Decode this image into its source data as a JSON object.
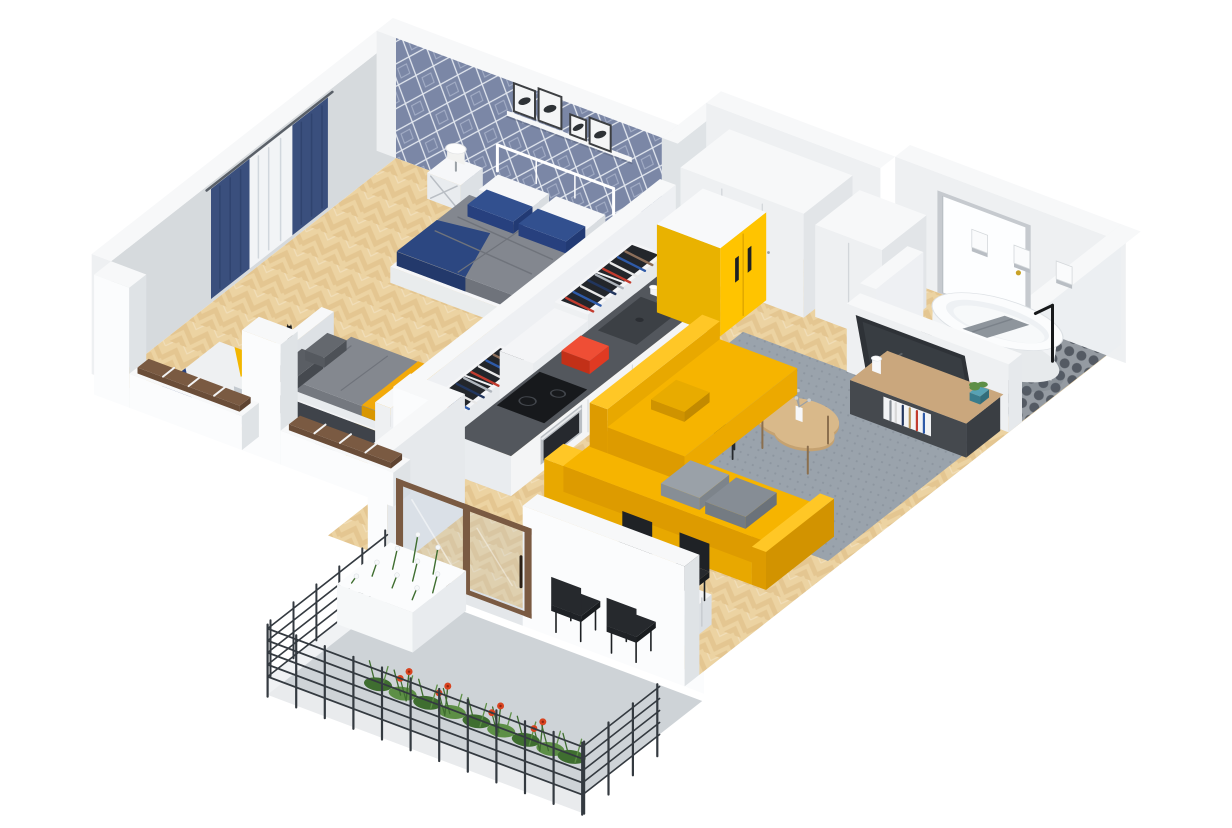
{
  "meta": {
    "description": "3D isometric cutaway floor plan render of a one-bedroom apartment: bedroom with blue diamond wallpaper, walk-through wardrobe, kitchen with yellow fridge, hallway with wardrobes and entrance door, bathroom with freestanding tub, living room with yellow corner sofa and TV, dining table, and a planted balcony with metal railing",
    "background": "#ffffff"
  },
  "colors": {
    "wall_top": "#f7f8f9",
    "wall_face": "#eef0f2",
    "wall_face_shade": "#dfe3e6",
    "wall_inner": "#d6dadd",
    "wall_bright": "#fbfcfd",
    "wallpaper_base": "#7b87a6",
    "wallpaper_line": "#e3e8f0",
    "wallpaper_accent": "#a6b0c8",
    "wood": "#ecd3a2",
    "wood_dark": "#ddbb83",
    "tile_bg": "#959ba2",
    "tile_dot": "#545a63",
    "ruglive_bg": "#9aa3ac",
    "ruglive_dot": "#8d96a0",
    "curtain_navy": "#3a4f7d",
    "curtain_sheer": "#f2f4f6",
    "duvet_grey": "#83878f",
    "duvet_fold": "#6f737b",
    "sheet_white": "#f6f7f9",
    "pillow_navy": "#32508f",
    "throw_navy": "#2c4781",
    "daybed_grey": "#84888f",
    "daybed_yellow": "#f2a90a",
    "frame_dark": "#45494e",
    "rug_white": "#eef0f2",
    "rug_grey": "#c3c9cf",
    "rug_yellow": "#f2b600",
    "rug_navy": "#2c4480",
    "counter_top": "#53575d",
    "sink_dark": "#3c4045",
    "appliance_steel": "#b9bec3",
    "hob_black": "#17191c",
    "toaster_red": "#e03a22",
    "fridge_yellow": "#ffc400",
    "fridge_yellow_dark": "#e2a900",
    "closet_dark": "#23262b",
    "tub_white": "#fbfcfd",
    "tub_shade": "#e7eaec",
    "towel_grey": "#8e959c",
    "tv_dark": "#2e3237",
    "sideboard": "#45494e",
    "sideboard_wood": "#caa77d",
    "sofa_yellow": "#f6b400",
    "sofa_dark": "#dd9b00",
    "cushion_a": "#9aa1a8",
    "cushion_b": "#868d95",
    "table_white": "#f3f4f6",
    "chair_black": "#26292d",
    "coffee_wood": "#d9b98a",
    "concrete": "#ced3d7",
    "concrete_edge": "#e9ebed",
    "railing": "#343a40",
    "green": "#5d8f46",
    "green_dark": "#3f6e30",
    "flower_red": "#d8431f",
    "flower_white": "#f6f8f9",
    "brown_frame": "#7a5a42",
    "glass_tint": "#b7c9d6",
    "gold": "#c9a227",
    "steel_grey": "#c9ced3"
  },
  "scene": {
    "bedroom": {
      "items": [
        "double-bed",
        "navy-pillows",
        "grey-duvet",
        "metal-headboard",
        "nightstand-left",
        "nightstand-right",
        "table-lamp-left",
        "table-lamp-right",
        "wall-shelf",
        "picture-frames",
        "diamond-wallpaper",
        "navy-curtains",
        "daybed",
        "yellow-stripe-blanket",
        "cat-figurine",
        "geometric-rug",
        "cut-open-windows"
      ]
    },
    "wardrobe_corridor": {
      "items": [
        "open-closet-upper",
        "open-closet-lower",
        "hanging-clothes"
      ]
    },
    "kitchen": {
      "items": [
        "counter",
        "dark-worktop",
        "sink",
        "faucet",
        "induction-hob",
        "oven",
        "red-toaster",
        "dishes",
        "yellow-fridge"
      ]
    },
    "hallway": {
      "items": [
        "tall-wardrobe",
        "small-wardrobe",
        "entrance-door",
        "gold-door-handle"
      ]
    },
    "bathroom": {
      "items": [
        "freestanding-bathtub",
        "black-floor-faucet",
        "grey-towel",
        "black-bowl",
        "penny-tile-floor",
        "wall-sconces",
        "wooden-mat",
        "tv-partition-wall"
      ]
    },
    "living_room": {
      "items": [
        "wall-tv",
        "media-sideboard",
        "books",
        "potted-plant",
        "white-vase",
        "grey-rug",
        "kidney-coffee-table",
        "black-side-table",
        "yellow-corner-sofa",
        "grey-cushions"
      ]
    },
    "dining": {
      "items": [
        "white-table",
        "black-chairs",
        "round-tray",
        "vase-with-greens",
        "open-magazine"
      ]
    },
    "balcony": {
      "items": [
        "metal-railing",
        "white-planter",
        "white-flowers",
        "red-flowers",
        "green-plants",
        "concrete-floor",
        "sliding-glass-door",
        "bronze-door-frame"
      ]
    }
  }
}
